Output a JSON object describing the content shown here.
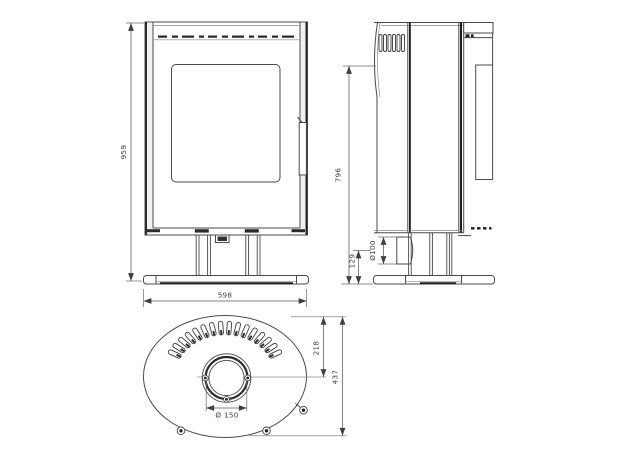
{
  "drawing": {
    "dimensions": {
      "overall_height": "959",
      "overall_width": "598",
      "flue_outlet_height": "796",
      "air_inlet_diameter": "Ø100",
      "air_inlet_center_height": "129",
      "flue_center_offset": "218",
      "overall_depth": "437",
      "flue_collar_diameter": "Ø 150"
    }
  }
}
